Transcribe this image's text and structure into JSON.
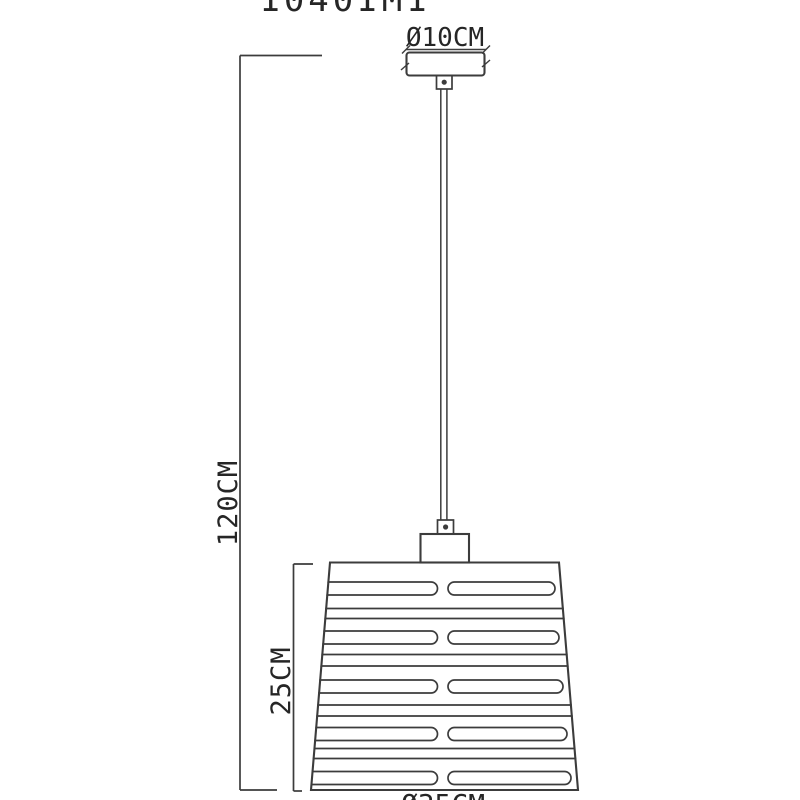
{
  "product_code": "1040IM1",
  "labels": {
    "canopy_diameter": "Ø10CM",
    "overall_height": "120CM",
    "shade_height": "25CM",
    "shade_diameter": "Ø35CM"
  },
  "colors": {
    "line": "#3c3c3c",
    "text": "#262626",
    "background": "#ffffff"
  }
}
